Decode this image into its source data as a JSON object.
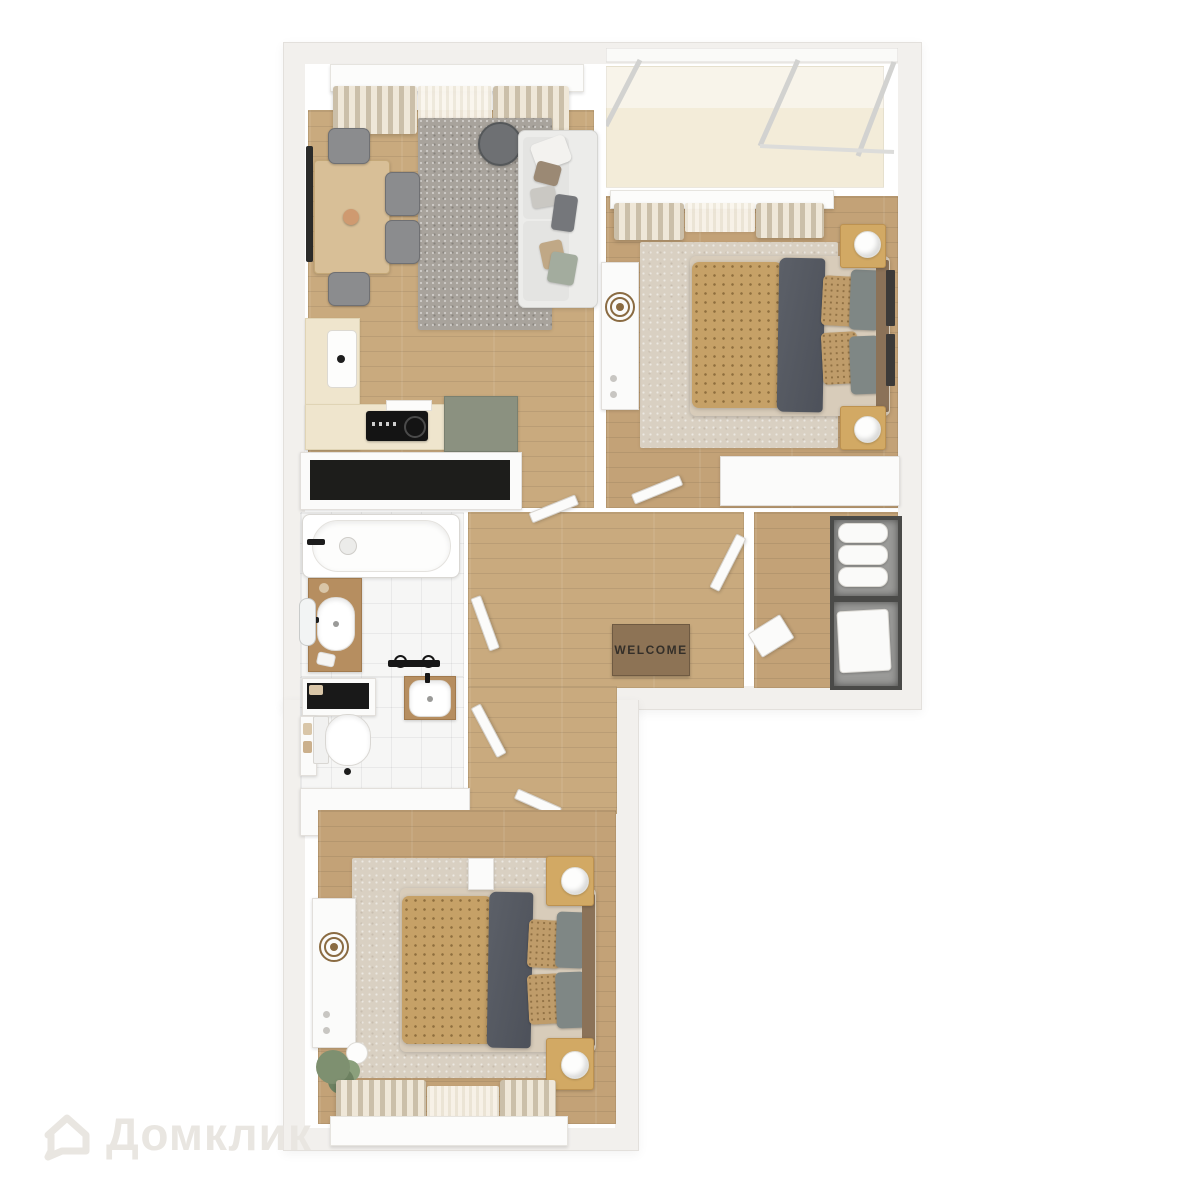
{
  "floorplan": {
    "welcome_mat": {
      "text": "WELCOME"
    },
    "watermark": {
      "icon": "house-icon",
      "text": "Домклик"
    },
    "palette": {
      "background": "#ffffff",
      "outer_wall": "#f2f0ed",
      "inner_wall": "#ffffff",
      "wood_floor": "#c9aa7e",
      "tile_floor": "#f6f6f5",
      "balcony_floor": "#f3ecd9",
      "rug_living_gray": "#a8a39c",
      "rug_bedroom_beige": "#d9d0c2",
      "duvet_tan": "#c6a167",
      "blanket_gray": "#565a63",
      "kitchen_cabinet_green": "#8b9180",
      "counter_cream": "#efe5cd",
      "vanity_wood": "#b68e60",
      "nightstand_wood": "#d2a964",
      "dark_storage_unit": "#1d1d1b",
      "welcome_mat_brown": "#8d7355",
      "watermark_gray": "#e9e6e1"
    }
  }
}
